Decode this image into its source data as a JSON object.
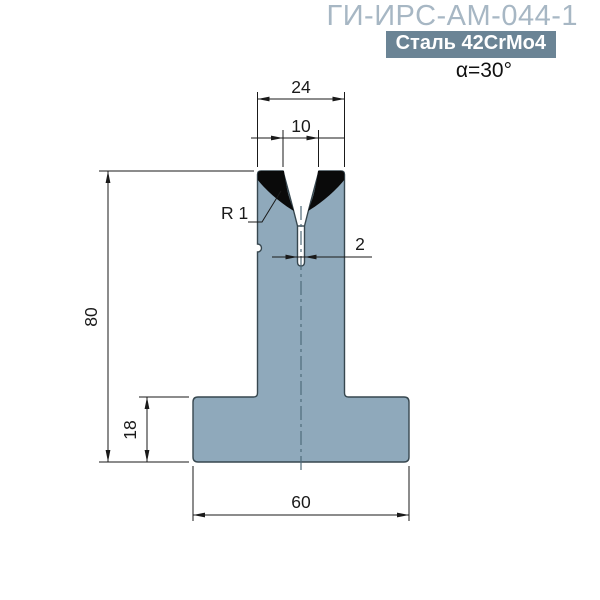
{
  "header": {
    "title": "ГИ-ИРС-АМ-044-1",
    "material_badge": "Сталь 42CrMo4",
    "angle": "α=30°"
  },
  "drawing": {
    "dimensions": {
      "shoulder_width": "24",
      "vee_opening": "10",
      "slot_width": "2",
      "total_height": "80",
      "base_height": "18",
      "base_width": "60",
      "radius": "R 1"
    },
    "colors": {
      "body_fill": "#8fa9bb",
      "body_stroke": "#37474f",
      "hardened_zone": "#0a0a0a",
      "centerline": "#4f6b7a",
      "dimension": "#1a1a1a",
      "title": "#a7b7c4",
      "badge_bg": "#6b8495",
      "badge_text": "#ffffff"
    }
  }
}
